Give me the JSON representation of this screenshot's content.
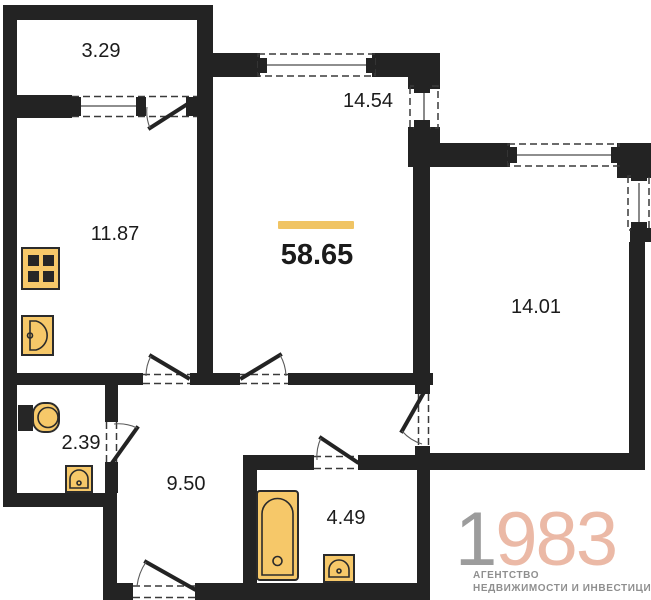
{
  "plan": {
    "total_area": {
      "value": "58.65"
    },
    "rooms": [
      {
        "name": "balcony",
        "area": "3.29"
      },
      {
        "name": "kitchen",
        "area": "11.87"
      },
      {
        "name": "living-room",
        "area": "14.54"
      },
      {
        "name": "bedroom",
        "area": "14.01"
      },
      {
        "name": "wc",
        "area": "2.39"
      },
      {
        "name": "hallway",
        "area": "9.50"
      },
      {
        "name": "bathroom",
        "area": "4.49"
      }
    ]
  },
  "logo": {
    "number_prefix": "1",
    "number_rest": "983",
    "tagline_line1": "АГЕНТСТВО",
    "tagline_line2": "НЕДВИЖИМОСТИ И ИНВЕСТИЦИЙ"
  },
  "colors": {
    "wall": "#232323",
    "accent": "#F0C464",
    "fixture": "#F6C869",
    "label": "#1B1B1B",
    "logo-gray": "#9C9C9C",
    "logo-salmon": "#EBB9A6",
    "tagline-gray": "#8F8F8F",
    "bg": "#FFFFFF"
  }
}
